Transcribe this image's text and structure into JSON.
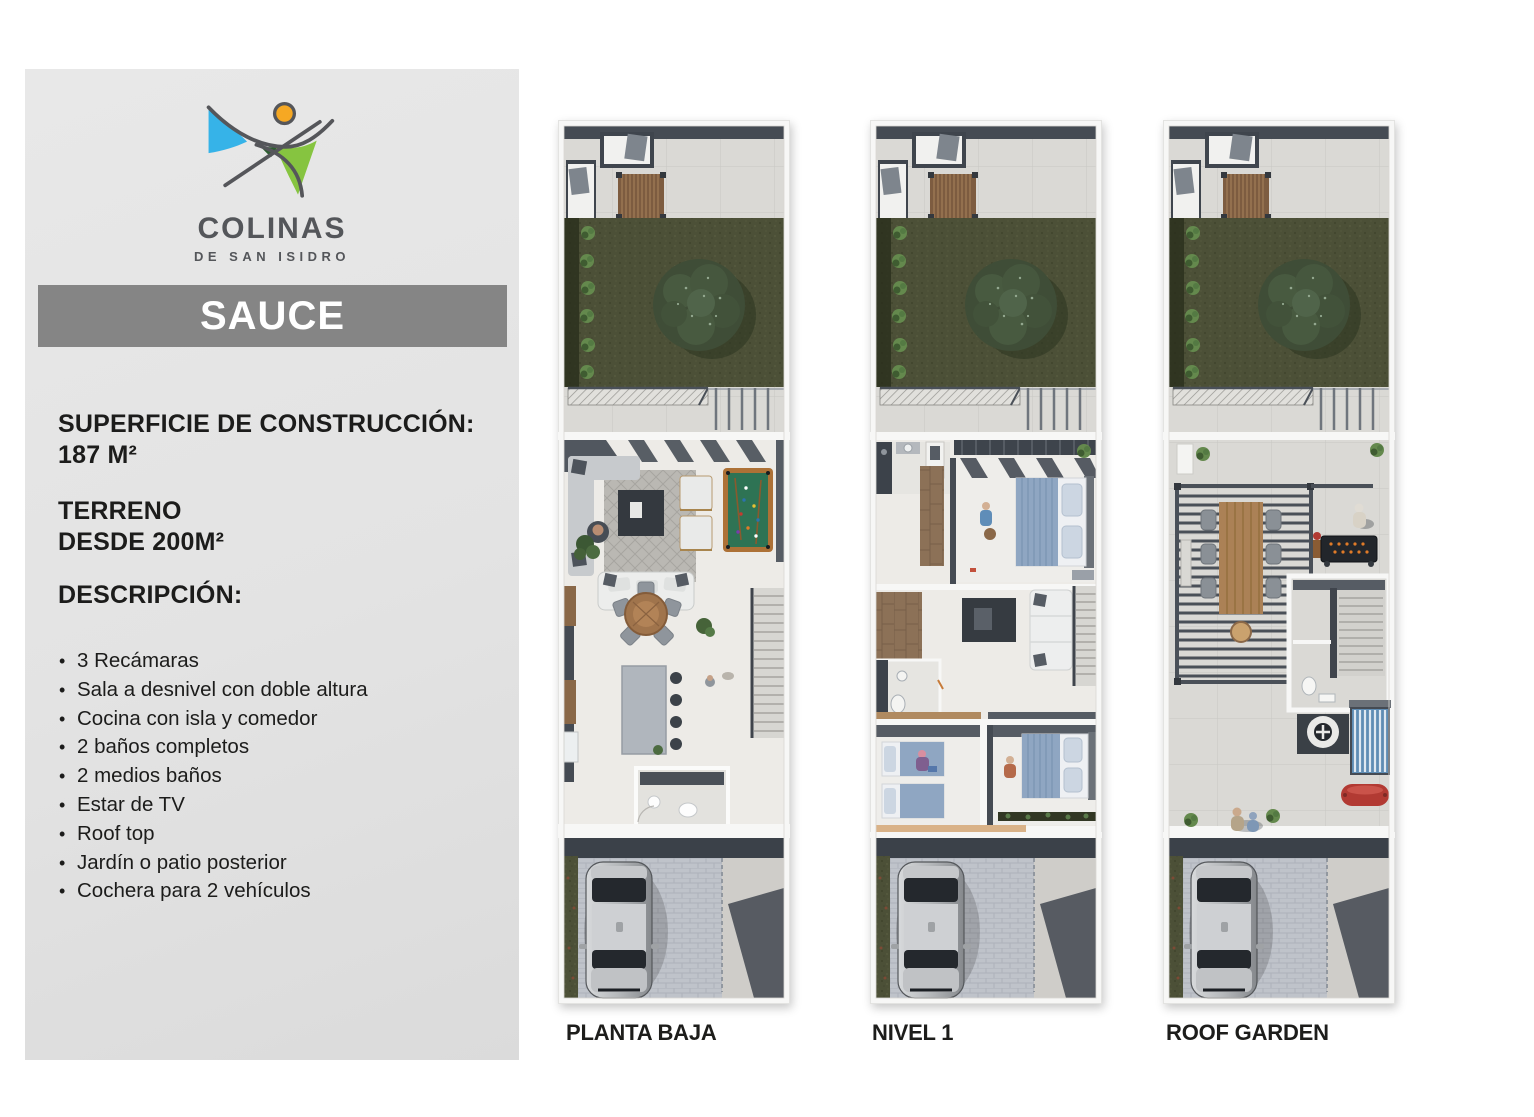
{
  "brand": {
    "name": "COLINAS",
    "subtitle": "DE SAN ISIDRO"
  },
  "model": {
    "title": "SAUCE"
  },
  "specs": {
    "construction_label": "SUPERFICIE DE CONSTRUCCIÓN:",
    "construction_value": "187 M²",
    "land_label": "TERRENO",
    "land_value": "DESDE 200M²"
  },
  "description": {
    "heading": "DESCRIPCIÓN:",
    "features": [
      "3 Recámaras",
      "Sala a desnivel con doble altura",
      "Cocina con isla y comedor",
      "2 baños completos",
      "2 medios baños",
      "Estar de TV",
      "Roof top",
      "Jardín o patio posterior",
      "Cochera para 2 vehículos"
    ]
  },
  "plans": {
    "planta_baja": {
      "label": "PLANTA BAJA"
    },
    "nivel_1": {
      "label": "NIVEL 1"
    },
    "roof_garden": {
      "label": "ROOF GARDEN"
    }
  },
  "colors": {
    "sidebar_panel": "#e3e3e3",
    "model_bar": "#858585",
    "text": "#1c1c1b",
    "logo_blue": "#36b3e8",
    "logo_green": "#86c440",
    "logo_dark_green": "#2e5e31",
    "logo_orange": "#f6a823",
    "logo_line": "#55565a",
    "garden_green": "#4c5037",
    "pool_table_green": "#2e7354",
    "tank_red": "#b23a33",
    "solar_blue": "#5f8db4"
  },
  "icons": {
    "logo": "colinas-hills-logo",
    "tree": "tree-top-view",
    "car": "car-top-view"
  }
}
